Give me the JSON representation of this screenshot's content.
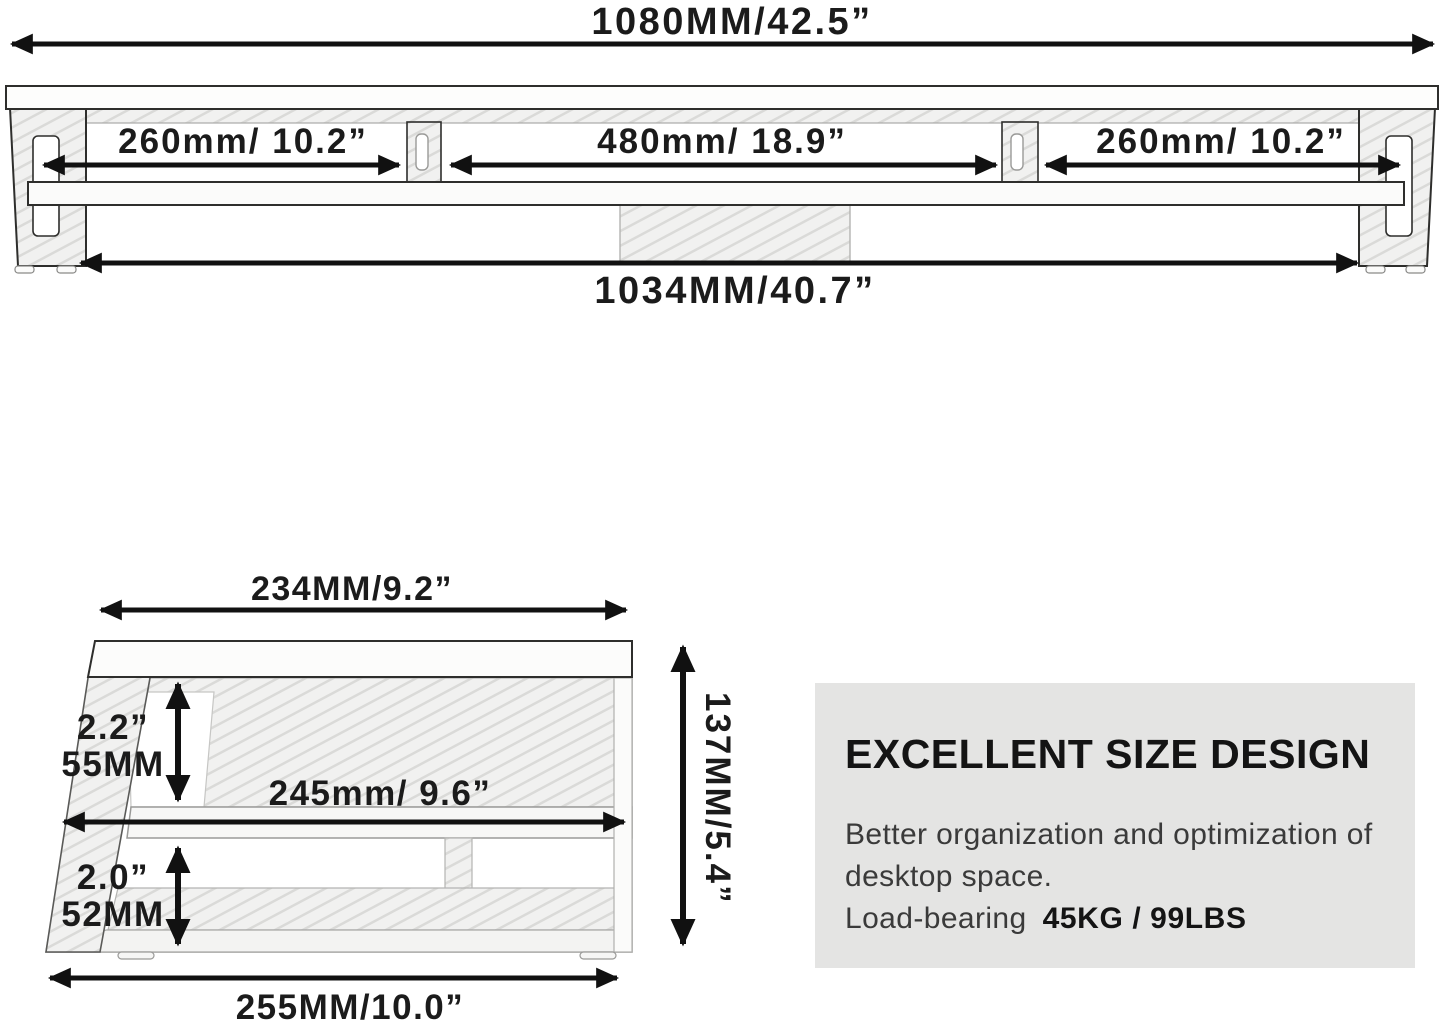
{
  "top_view": {
    "total_width_label": "1080MM/42.5”",
    "left_section_label": "260mm/ 10.2”",
    "center_section_label": "480mm/ 18.9”",
    "right_section_label": "260mm/ 10.2”",
    "base_width_label": "1034MM/40.7”"
  },
  "side_view": {
    "top_depth_label": "234MM/9.2”",
    "upper_clearance_inch_label": "2.2”",
    "upper_clearance_mm_label": "55MM",
    "shelf_depth_label": "245mm/ 9.6”",
    "lower_clearance_inch_label": "2.0”",
    "lower_clearance_mm_label": "52MM",
    "total_height_label": "137MM/5.4”",
    "base_depth_label": "255MM/10.0”"
  },
  "info_box": {
    "title": "EXCELLENT SIZE DESIGN",
    "line1": "Better organization and optimization of",
    "line2": "desktop space.",
    "line3_prefix": "Load-bearing",
    "line3_value": "45KG / 99LBS",
    "background_color": "#e4e4e3"
  },
  "colors": {
    "line": "#161616",
    "drawing_outline": "#2e2e2c",
    "hatch_fill": "#f1f1f0",
    "hatch_stroke": "#dadad8"
  }
}
